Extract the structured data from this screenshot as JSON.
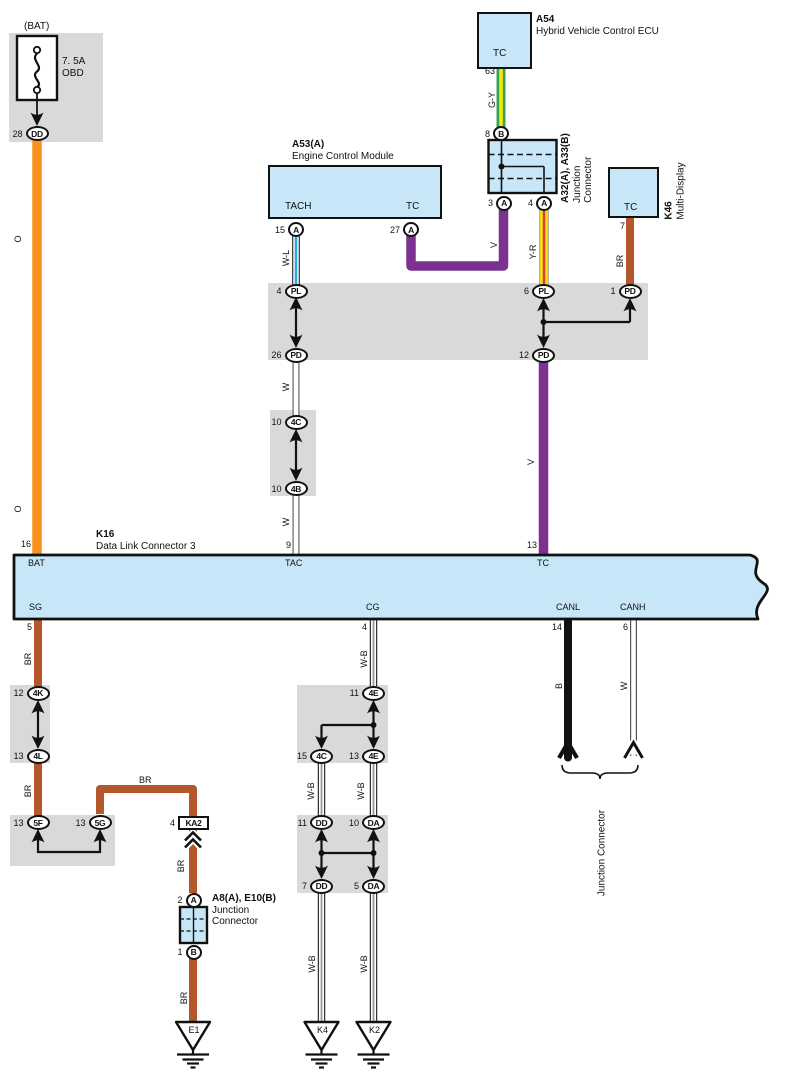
{
  "colors": {
    "orange": "#F6921E",
    "purple": "#7C3190",
    "brown": "#B4572D",
    "green": "#33A457",
    "yellow": "#FFE600",
    "red": "#E23B3B",
    "light_blue_stripe": "#29ABE2",
    "component_fill": "#C7E6F7",
    "panel_gray": "#D9D9D9",
    "wire_black": "#111111"
  },
  "fuse": {
    "title": "(BAT)",
    "rating": "7. 5A",
    "name": "OBD"
  },
  "a54": {
    "id": "A54",
    "name": "Hybrid Vehicle Control ECU",
    "terminal": "TC",
    "pin": "63"
  },
  "a53": {
    "id": "A53(A)",
    "name": "Engine Control Module",
    "terminal_tach": "TACH",
    "terminal_tc": "TC"
  },
  "a32": {
    "id": "A32(A), A33(B)",
    "name_line1": "Junction",
    "name_line2": "Connector"
  },
  "k46": {
    "id": "K46",
    "name": "Multi-Display",
    "terminal": "TC",
    "pin": "7"
  },
  "k16": {
    "id": "K16",
    "name": "Data Link Connector 3",
    "bat": "BAT",
    "tac": "TAC",
    "tc": "TC",
    "sg": "SG",
    "cg": "CG",
    "canl": "CANL",
    "canh": "CANH",
    "pin_bat": "16",
    "pin_tac": "9",
    "pin_tc": "13",
    "pin_sg": "5",
    "pin_cg": "4",
    "pin_canl": "14",
    "pin_canh": "6"
  },
  "a8": {
    "id": "A8(A), E10(B)",
    "name_line1": "Junction",
    "name_line2": "Connector"
  },
  "junction_connector_label": "Junction Connector",
  "wire_labels": {
    "o": "O",
    "gy": "G-Y",
    "wl": "W-L",
    "v": "V",
    "yr": "Y-R",
    "br": "BR",
    "w": "W",
    "wb": "W-B",
    "b": "B"
  },
  "connectors": {
    "dd28": {
      "pin": "28",
      "code": "DD"
    },
    "b8": {
      "pin": "8",
      "code": "B"
    },
    "a3": {
      "pin": "3",
      "code": "A"
    },
    "a4": {
      "pin": "4",
      "code": "A"
    },
    "a15": {
      "pin": "15",
      "code": "A"
    },
    "a27": {
      "pin": "27",
      "code": "A"
    },
    "pl4": {
      "pin": "4",
      "code": "PL"
    },
    "pd26": {
      "pin": "26",
      "code": "PD"
    },
    "pl6": {
      "pin": "6",
      "code": "PL"
    },
    "pd1": {
      "pin": "1",
      "code": "PD"
    },
    "pd12": {
      "pin": "12",
      "code": "PD"
    },
    "c4c10": {
      "pin": "10",
      "code": "4C"
    },
    "c4b10": {
      "pin": "10",
      "code": "4B"
    },
    "c4k12": {
      "pin": "12",
      "code": "4K"
    },
    "c4l13": {
      "pin": "13",
      "code": "4L"
    },
    "c5f13": {
      "pin": "13",
      "code": "5F"
    },
    "c5g13": {
      "pin": "13",
      "code": "5G"
    },
    "ka2": {
      "pin": "4",
      "code": "KA2"
    },
    "a2": {
      "pin": "2",
      "code": "A"
    },
    "b1": {
      "pin": "1",
      "code": "B"
    },
    "c4e11": {
      "pin": "11",
      "code": "4E"
    },
    "c4c15": {
      "pin": "15",
      "code": "4C"
    },
    "c4e13": {
      "pin": "13",
      "code": "4E"
    },
    "dd11": {
      "pin": "11",
      "code": "DD"
    },
    "da10": {
      "pin": "10",
      "code": "DA"
    },
    "dd7": {
      "pin": "7",
      "code": "DD"
    },
    "da5": {
      "pin": "5",
      "code": "DA"
    }
  },
  "grounds": {
    "e1": "E1",
    "k4": "K4",
    "k2": "K2"
  }
}
